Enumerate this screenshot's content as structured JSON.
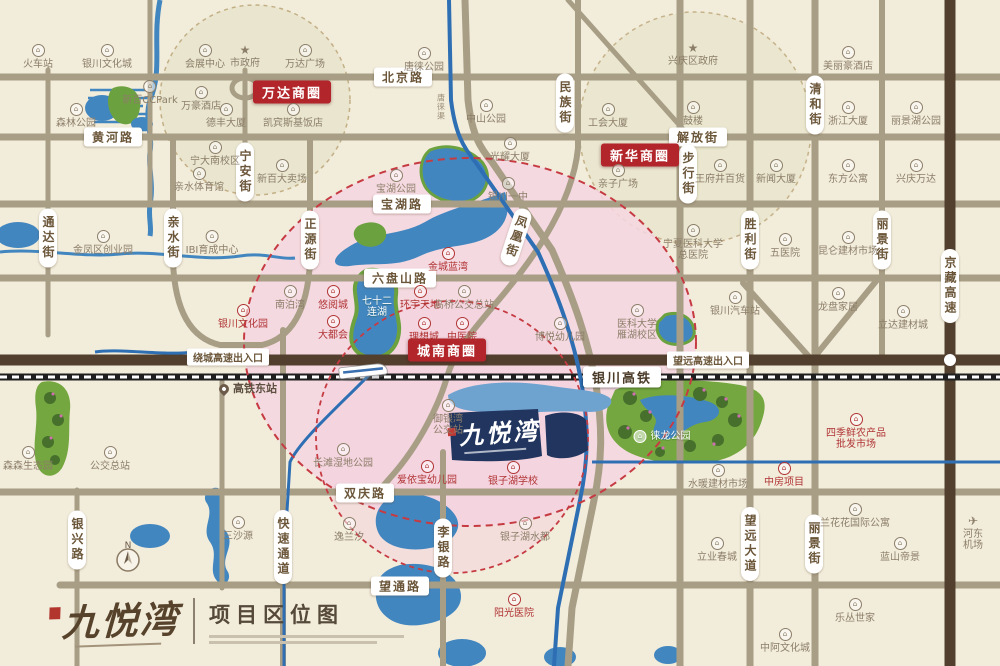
{
  "brand": {
    "name": "九悦湾",
    "map_title": "项目区位图"
  },
  "project_marker": {
    "name": "九悦湾"
  },
  "compass": {
    "n": "N"
  },
  "rail_label": {
    "x": 622,
    "y": 377,
    "t": "银川高铁"
  },
  "canal_label": {
    "x": 441,
    "y": 107,
    "t": "唐徕渠"
  },
  "colors": {
    "background": "#f2ecdb",
    "road": "#a89e86",
    "highway": "#523f2e",
    "water": "#4286c0",
    "park": "#74a73f",
    "pink_zone": "#f6d6e2",
    "zone_dash": "#c63b42",
    "label_text": "#6b5639",
    "district_bg": "#b2252a",
    "poi_red": "#b03434",
    "poi_gray": "#8c7e68",
    "project_navy": "#21355f"
  },
  "road_labels_h": [
    {
      "x": 113,
      "y": 137,
      "t": "黄河路"
    },
    {
      "x": 403,
      "y": 77,
      "t": "北京路"
    },
    {
      "x": 698,
      "y": 137,
      "t": "解放街"
    },
    {
      "x": 402,
      "y": 204,
      "t": "宝湖路"
    },
    {
      "x": 400,
      "y": 278,
      "t": "六盘山路"
    },
    {
      "x": 365,
      "y": 493,
      "t": "双庆路"
    },
    {
      "x": 400,
      "y": 586,
      "t": "望通路"
    }
  ],
  "road_labels_v": [
    {
      "x": 245,
      "y": 172,
      "t": "宁安街",
      "rot": 0
    },
    {
      "x": 565,
      "y": 103,
      "t": "民族街",
      "rot": 0
    },
    {
      "x": 815,
      "y": 105,
      "t": "清和街",
      "rot": 0
    },
    {
      "x": 48,
      "y": 238,
      "t": "通达街",
      "rot": 0
    },
    {
      "x": 173,
      "y": 238,
      "t": "亲水街",
      "rot": 0
    },
    {
      "x": 310,
      "y": 240,
      "t": "正源街",
      "rot": 0
    },
    {
      "x": 516,
      "y": 237,
      "t": "凤凰街",
      "rot": 18
    },
    {
      "x": 750,
      "y": 240,
      "t": "胜利街",
      "rot": 0
    },
    {
      "x": 882,
      "y": 240,
      "t": "丽景街",
      "rot": 0
    },
    {
      "x": 950,
      "y": 286,
      "t": "京藏高速",
      "rot": 0
    },
    {
      "x": 688,
      "y": 174,
      "t": "步行街",
      "rot": 0
    },
    {
      "x": 77,
      "y": 540,
      "t": "银兴路",
      "rot": 0
    },
    {
      "x": 283,
      "y": 547,
      "t": "快速通道",
      "rot": 0
    },
    {
      "x": 443,
      "y": 548,
      "t": "李银路",
      "rot": 0
    },
    {
      "x": 750,
      "y": 544,
      "t": "望远大道",
      "rot": 0
    },
    {
      "x": 814,
      "y": 544,
      "t": "丽景街",
      "rot": 0
    }
  ],
  "entrance_labels": [
    {
      "x": 228,
      "y": 357,
      "t": "绕城高速出入口"
    },
    {
      "x": 708,
      "y": 360,
      "t": "望远高速出入口"
    }
  ],
  "area_labels": [
    {
      "x": 292,
      "y": 92,
      "t": "万达商圈"
    },
    {
      "x": 640,
      "y": 155,
      "t": "新华商圈"
    },
    {
      "x": 447,
      "y": 350,
      "t": "城南商圈"
    }
  ],
  "pois": [
    {
      "x": 38,
      "y": 44,
      "t": "火车站",
      "c": "g",
      "i": "b"
    },
    {
      "x": 107,
      "y": 44,
      "t": "银川文化城",
      "c": "g",
      "i": "b"
    },
    {
      "x": 205,
      "y": 44,
      "t": "会展中心",
      "c": "g",
      "i": "b"
    },
    {
      "x": 245,
      "y": 44,
      "t": "市政府",
      "c": "g",
      "i": "s"
    },
    {
      "x": 305,
      "y": 44,
      "t": "万达广场",
      "c": "g",
      "i": "b"
    },
    {
      "x": 150,
      "y": 80,
      "t": "新百CCPark",
      "c": "g",
      "i": "b"
    },
    {
      "x": 201,
      "y": 86,
      "t": "万豪酒店",
      "c": "g",
      "i": "b"
    },
    {
      "x": 226,
      "y": 103,
      "t": "德丰大厦",
      "c": "g",
      "i": "b"
    },
    {
      "x": 293,
      "y": 103,
      "t": "凯宾斯基饭店",
      "c": "g",
      "i": "b"
    },
    {
      "x": 76,
      "y": 103,
      "t": "森林公园",
      "c": "g",
      "i": "b"
    },
    {
      "x": 215,
      "y": 141,
      "t": "宁大南校区",
      "c": "g",
      "i": "b"
    },
    {
      "x": 282,
      "y": 159,
      "t": "新百大卖场",
      "c": "g",
      "i": "b"
    },
    {
      "x": 199,
      "y": 167,
      "t": "亲水体育馆",
      "c": "g",
      "i": "b"
    },
    {
      "x": 424,
      "y": 47,
      "t": "唐徕公园",
      "c": "g",
      "i": "b"
    },
    {
      "x": 486,
      "y": 99,
      "t": "中山公园",
      "c": "g",
      "i": "b"
    },
    {
      "x": 608,
      "y": 103,
      "t": "工会大厦",
      "c": "g",
      "i": "b"
    },
    {
      "x": 510,
      "y": 137,
      "t": "光耀大厦",
      "c": "g",
      "i": "b"
    },
    {
      "x": 508,
      "y": 177,
      "t": "银川一中",
      "c": "g",
      "i": "b"
    },
    {
      "x": 693,
      "y": 42,
      "t": "兴庆区政府",
      "c": "g",
      "i": "s"
    },
    {
      "x": 693,
      "y": 101,
      "t": "鼓楼",
      "c": "g",
      "i": "b"
    },
    {
      "x": 848,
      "y": 46,
      "t": "美丽豪酒店",
      "c": "g",
      "i": "b"
    },
    {
      "x": 848,
      "y": 101,
      "t": "浙江大厦",
      "c": "g",
      "i": "b"
    },
    {
      "x": 916,
      "y": 101,
      "t": "丽景湖公园",
      "c": "g",
      "i": "b"
    },
    {
      "x": 618,
      "y": 164,
      "t": "亲子广场",
      "c": "g",
      "i": "b"
    },
    {
      "x": 720,
      "y": 159,
      "t": "王府井百货",
      "c": "g",
      "i": "b"
    },
    {
      "x": 776,
      "y": 159,
      "t": "新闻大厦",
      "c": "g",
      "i": "b"
    },
    {
      "x": 848,
      "y": 159,
      "t": "东方公寓",
      "c": "g",
      "i": "b"
    },
    {
      "x": 916,
      "y": 159,
      "t": "兴庆万达",
      "c": "g",
      "i": "b"
    },
    {
      "x": 103,
      "y": 230,
      "t": "金凤区创业园",
      "c": "g",
      "i": "b"
    },
    {
      "x": 212,
      "y": 230,
      "t": "IBI育成中心",
      "c": "g",
      "i": "b"
    },
    {
      "x": 396,
      "y": 169,
      "t": "宝湖公园",
      "c": "g",
      "i": "b"
    },
    {
      "x": 448,
      "y": 247,
      "t": "金城蓝湾",
      "c": "r",
      "i": "b"
    },
    {
      "x": 243,
      "y": 304,
      "t": "银川文化园",
      "c": "r",
      "i": "b"
    },
    {
      "x": 290,
      "y": 285,
      "t": "南泊湾",
      "c": "g",
      "i": "b"
    },
    {
      "x": 333,
      "y": 285,
      "t": "悠阅城",
      "c": "r",
      "i": "b"
    },
    {
      "x": 333,
      "y": 315,
      "t": "大都会",
      "c": "r",
      "i": "b"
    },
    {
      "x": 377,
      "y": 296,
      "t": "七十二\n连湖",
      "c": "w",
      "i": "n"
    },
    {
      "x": 420,
      "y": 285,
      "t": "环宇天地",
      "c": "r",
      "i": "b"
    },
    {
      "x": 464,
      "y": 285,
      "t": "高桥公交总站",
      "c": "g",
      "i": "b"
    },
    {
      "x": 424,
      "y": 317,
      "t": "理想城",
      "c": "r",
      "i": "b"
    },
    {
      "x": 462,
      "y": 317,
      "t": "中医院",
      "c": "r",
      "i": "b"
    },
    {
      "x": 560,
      "y": 317,
      "t": "博悦幼儿园",
      "c": "g",
      "i": "b"
    },
    {
      "x": 637,
      "y": 304,
      "t": "医科大学\n雁湖校区",
      "c": "g",
      "i": "b"
    },
    {
      "x": 693,
      "y": 224,
      "t": "宁夏医科大学\n总医院",
      "c": "g",
      "i": "b"
    },
    {
      "x": 785,
      "y": 233,
      "t": "五医院",
      "c": "g",
      "i": "b"
    },
    {
      "x": 848,
      "y": 231,
      "t": "昆仑建材市场",
      "c": "g",
      "i": "b"
    },
    {
      "x": 735,
      "y": 291,
      "t": "银川汽车站",
      "c": "g",
      "i": "b"
    },
    {
      "x": 838,
      "y": 287,
      "t": "龙盘家居",
      "c": "g",
      "i": "b"
    },
    {
      "x": 903,
      "y": 305,
      "t": "立达建材城",
      "c": "g",
      "i": "b"
    },
    {
      "x": 248,
      "y": 383,
      "t": "高铁东站",
      "c": "d",
      "i": "pin",
      "row": true
    },
    {
      "x": 448,
      "y": 399,
      "t": "御银湾\n公交站",
      "c": "g",
      "i": "b"
    },
    {
      "x": 343,
      "y": 443,
      "t": "长滩湿地公园",
      "c": "g",
      "i": "b"
    },
    {
      "x": 427,
      "y": 460,
      "t": "爱依宝幼儿园",
      "c": "r",
      "i": "b"
    },
    {
      "x": 513,
      "y": 461,
      "t": "银子湖学校",
      "c": "r",
      "i": "b"
    },
    {
      "x": 662,
      "y": 430,
      "t": "徕龙公园",
      "c": "w",
      "i": "b",
      "row": true
    },
    {
      "x": 856,
      "y": 413,
      "t": "四季鲜农产品\n批发市场",
      "c": "r",
      "i": "b"
    },
    {
      "x": 718,
      "y": 464,
      "t": "水暖建材市场",
      "c": "g",
      "i": "b"
    },
    {
      "x": 784,
      "y": 462,
      "t": "中房项目",
      "c": "r",
      "i": "b"
    },
    {
      "x": 28,
      "y": 446,
      "t": "森森生态园",
      "c": "g",
      "i": "b"
    },
    {
      "x": 110,
      "y": 446,
      "t": "公交总站",
      "c": "g",
      "i": "b"
    },
    {
      "x": 238,
      "y": 516,
      "t": "三沙源",
      "c": "g",
      "i": "b"
    },
    {
      "x": 349,
      "y": 517,
      "t": "逸兰汐",
      "c": "g",
      "i": "b"
    },
    {
      "x": 525,
      "y": 517,
      "t": "银子湖水都",
      "c": "g",
      "i": "b"
    },
    {
      "x": 514,
      "y": 593,
      "t": "阳光医院",
      "c": "r",
      "i": "b"
    },
    {
      "x": 717,
      "y": 537,
      "t": "立业春城",
      "c": "g",
      "i": "b"
    },
    {
      "x": 855,
      "y": 503,
      "t": "兰花花国际公寓",
      "c": "g",
      "i": "b"
    },
    {
      "x": 900,
      "y": 537,
      "t": "蓝山帝景",
      "c": "g",
      "i": "b"
    },
    {
      "x": 973,
      "y": 515,
      "t": "河东机场",
      "c": "g",
      "i": "p"
    },
    {
      "x": 855,
      "y": 598,
      "t": "乐丛世家",
      "c": "g",
      "i": "b"
    },
    {
      "x": 785,
      "y": 628,
      "t": "中阿文化城",
      "c": "g",
      "i": "b"
    }
  ]
}
